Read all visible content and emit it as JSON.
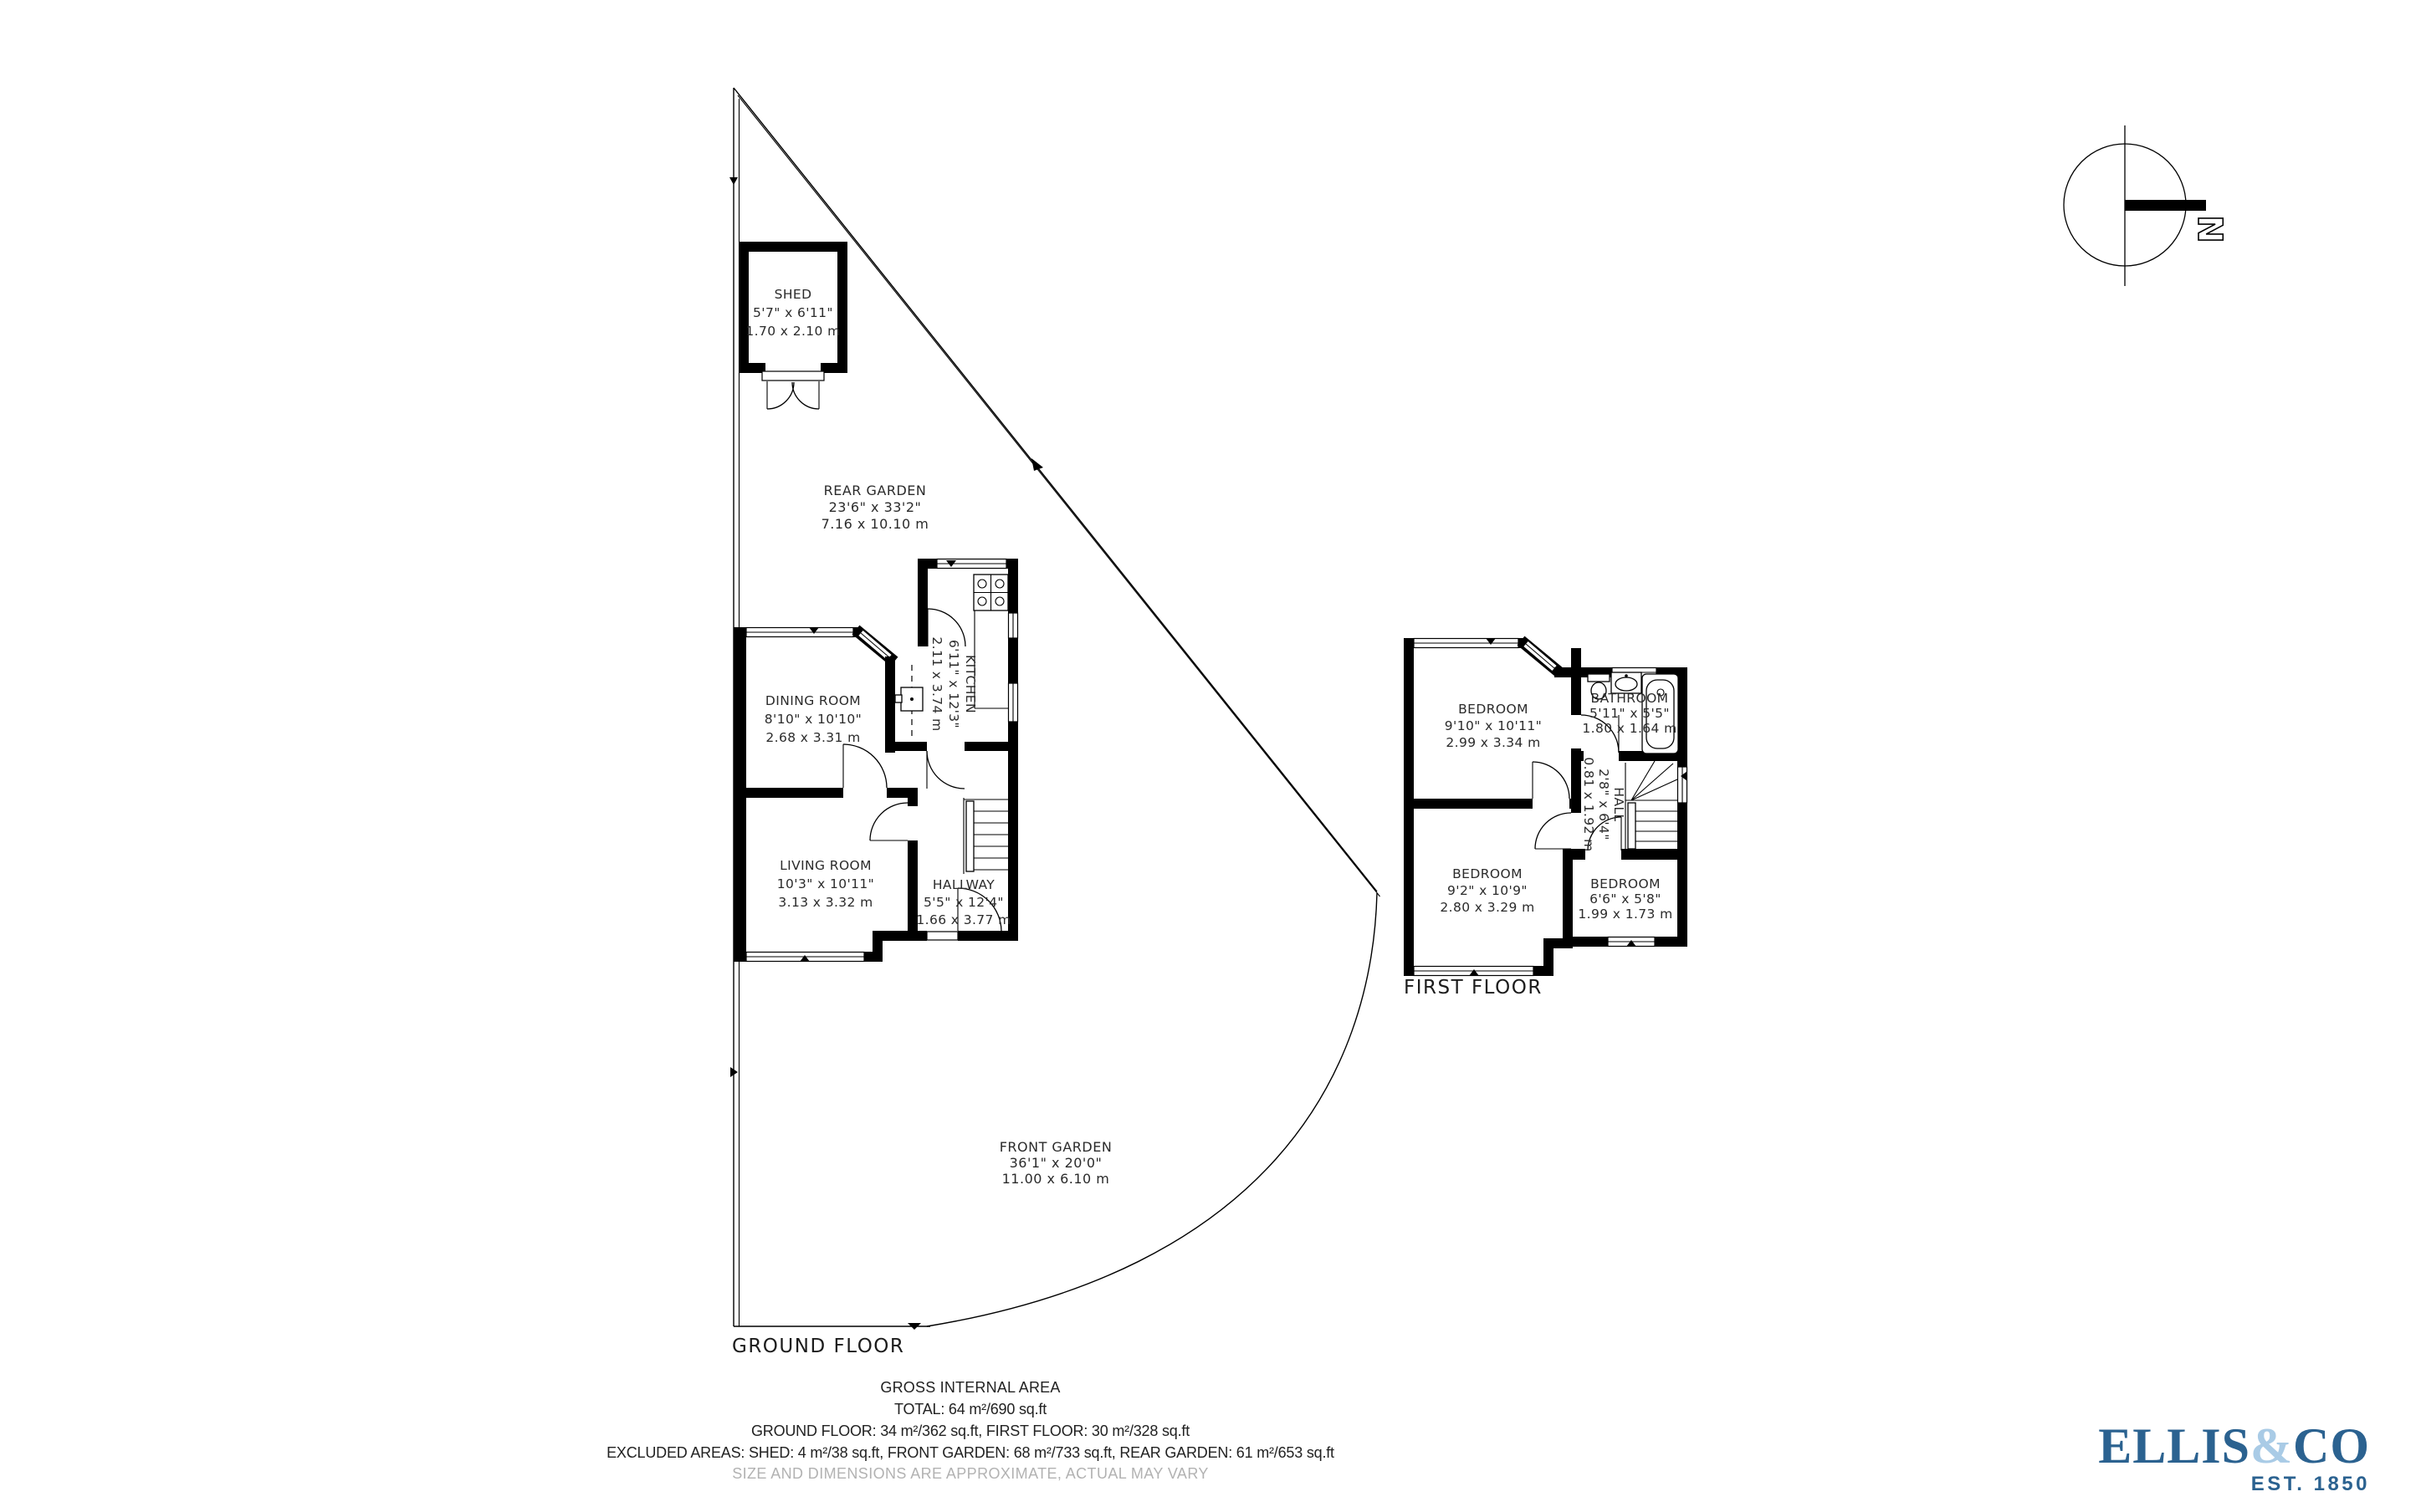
{
  "ground_floor": {
    "label": "GROUND FLOOR",
    "shed": {
      "name": "SHED",
      "imperial": "5'7\" x 6'11\"",
      "metric": "1.70 x 2.10 m"
    },
    "rear_garden": {
      "name": "REAR GARDEN",
      "imperial": "23'6\" x 33'2\"",
      "metric": "7.16 x 10.10 m"
    },
    "front_garden": {
      "name": "FRONT GARDEN",
      "imperial": "36'1\" x 20'0\"",
      "metric": "11.00 x 6.10 m"
    },
    "kitchen": {
      "name": "KITCHEN",
      "imperial": "6'11\" x 12'3\"",
      "metric": "2.11 x 3.74 m"
    },
    "dining_room": {
      "name": "DINING ROOM",
      "imperial": "8'10\" x 10'10\"",
      "metric": "2.68 x 3.31 m"
    },
    "living_room": {
      "name": "LIVING ROOM",
      "imperial": "10'3\" x 10'11\"",
      "metric": "3.13 x 3.32 m"
    },
    "hallway": {
      "name": "HALLWAY",
      "imperial": "5'5\" x 12'4\"",
      "metric": "1.66 x 3.77 m"
    }
  },
  "first_floor": {
    "label": "FIRST FLOOR",
    "bedroom1": {
      "name": "BEDROOM",
      "imperial": "9'10\" x 10'11\"",
      "metric": "2.99 x 3.34 m"
    },
    "bathroom": {
      "name": "BATHROOM",
      "imperial": "5'11\" x 5'5\"",
      "metric": "1.80 x 1.64 m"
    },
    "hall": {
      "name": "HALL",
      "imperial": "2'8\" x 6'4\"",
      "metric": "0.81 x 1.92 m"
    },
    "bedroom2": {
      "name": "BEDROOM",
      "imperial": "9'2\" x 10'9\"",
      "metric": "2.80 x 3.29 m"
    },
    "bedroom3": {
      "name": "BEDROOM",
      "imperial": "6'6\" x 5'8\"",
      "metric": "1.99 x 1.73 m"
    }
  },
  "summary": {
    "title": "GROSS INTERNAL AREA",
    "total": "TOTAL: 64 m²/690 sq.ft",
    "floors": "GROUND FLOOR: 34 m²/362 sq.ft, FIRST FLOOR: 30 m²/328 sq.ft",
    "excluded": "EXCLUDED AREAS: SHED: 4 m²/38 sq.ft, FRONT GARDEN: 68 m²/733 sq.ft, REAR GARDEN: 61 m²/653 sq.ft",
    "disclaimer": "SIZE AND DIMENSIONS ARE APPROXIMATE, ACTUAL MAY VARY"
  },
  "compass": {
    "north": "N"
  },
  "logo": {
    "ellis": "ELLIS",
    "amp": "&",
    "co": "CO",
    "est": "EST. 1850"
  },
  "colors": {
    "ink": "#000000",
    "text": "#2b2b2b",
    "muted": "#b2b2b2",
    "brand_dark": "#2b6290",
    "brand_light": "#a9cbe6"
  }
}
